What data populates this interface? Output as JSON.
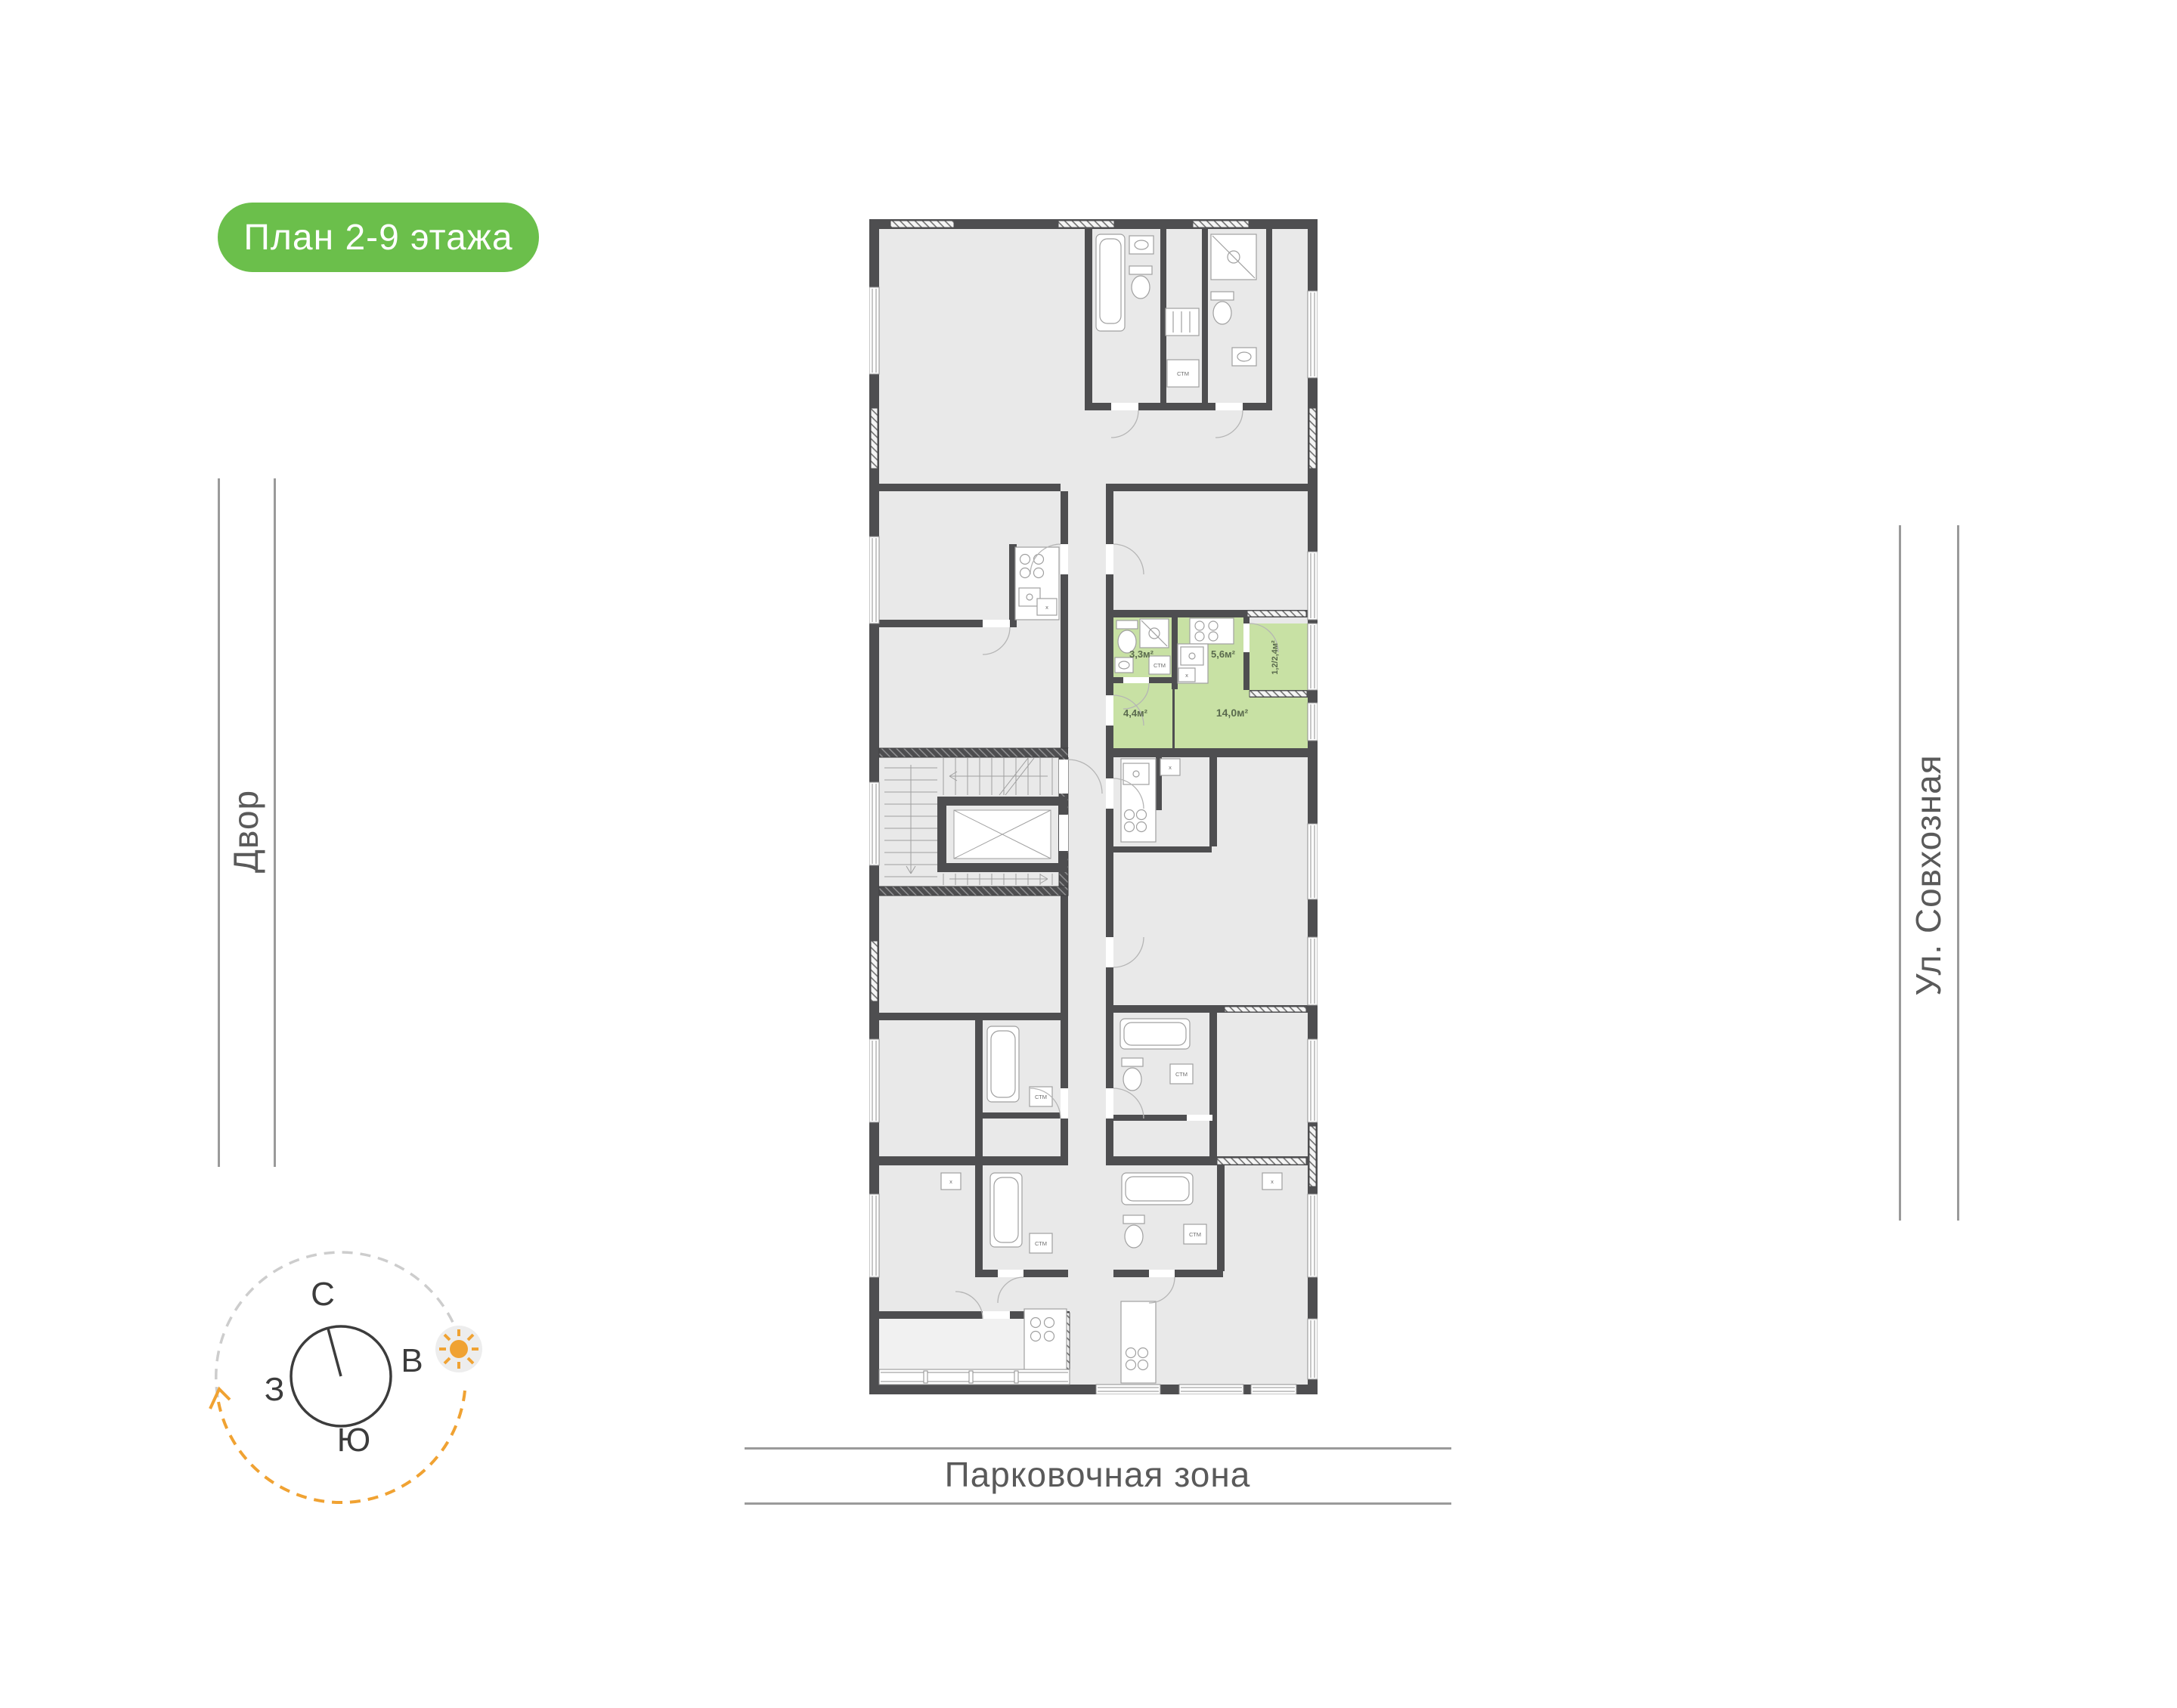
{
  "badge": {
    "label": "План 2-9 этажа"
  },
  "surroundings": {
    "left_label": "Двор",
    "right_label": "Ул. Совхозная",
    "bottom_label": "Парковочная зона"
  },
  "compass": {
    "north": "С",
    "east": "В",
    "west": "З",
    "south": "Ю"
  },
  "plan": {
    "apartment": {
      "rooms": [
        {
          "name": "bathroom",
          "area": "3,3м²"
        },
        {
          "name": "kitchen",
          "area": "5,6м²"
        },
        {
          "name": "hallway",
          "area": "4,4м²"
        },
        {
          "name": "living-room",
          "area": "14,0м²"
        },
        {
          "name": "balcony",
          "area": "1,2/2,4м²"
        }
      ]
    },
    "labels": {
      "washing_machine": "СТМ",
      "vent": "x"
    }
  },
  "colors": {
    "badge_green": "#6bbf4b",
    "apartment_green": "#c8e1a4",
    "wall": "#4e4e50",
    "room": "#e9e9e9",
    "accent_orange": "#f0a232"
  }
}
